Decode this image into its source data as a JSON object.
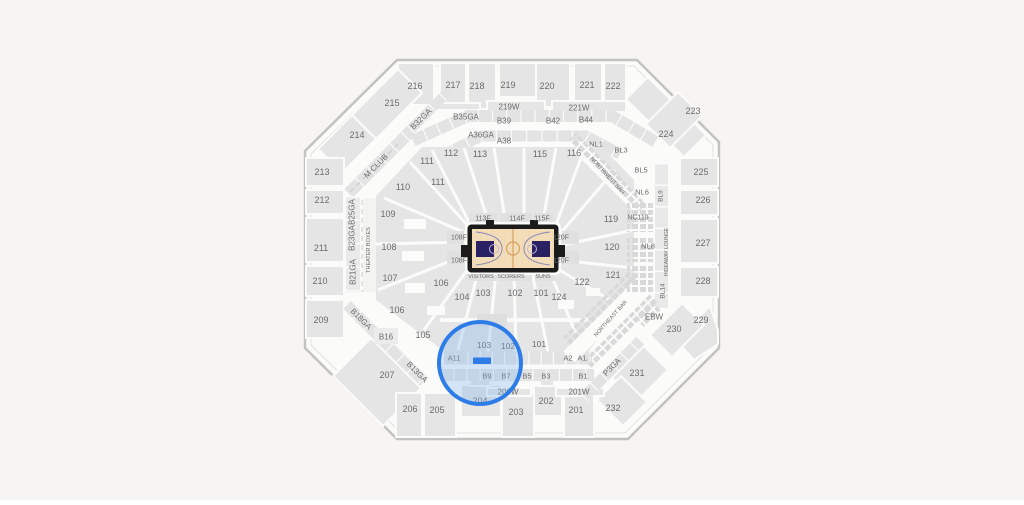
{
  "map_title": "Arena seating map with selected section highlighted",
  "background": "#f6f5f3",
  "colors": {
    "section_fill": "#e5e5e5",
    "arena_floor": "#fbfbfa",
    "outline": "#c2c2c0",
    "label": "#6b6b6b",
    "court_floor": "#f2ddb8",
    "court_border": "#1b1b1b",
    "court_key": "#2a2163",
    "court_lines": "#d9a05f",
    "highlight_blue": "#2e7ce8"
  },
  "highlight": {
    "cx": 480,
    "cy": 363,
    "r": 41,
    "stroke": "#2e7ce8",
    "stroke_width": 4,
    "fill": "#7fb3ef",
    "fill_opacity": 0.32,
    "marker": {
      "x": 473,
      "y": 357.5,
      "w": 18,
      "h": 6.5,
      "fill": "#2e7ce8"
    }
  },
  "labels": [
    {
      "t": "216",
      "x": 415,
      "y": 86
    },
    {
      "t": "217",
      "x": 453,
      "y": 85
    },
    {
      "t": "218",
      "x": 477,
      "y": 86
    },
    {
      "t": "219",
      "x": 508,
      "y": 85
    },
    {
      "t": "220",
      "x": 547,
      "y": 86
    },
    {
      "t": "221",
      "x": 587,
      "y": 85
    },
    {
      "t": "222",
      "x": 613,
      "y": 86
    },
    {
      "t": "215",
      "x": 392,
      "y": 103
    },
    {
      "t": "223",
      "x": 693,
      "y": 111
    },
    {
      "t": "214",
      "x": 357,
      "y": 135
    },
    {
      "t": "224",
      "x": 666,
      "y": 134
    },
    {
      "t": "213",
      "x": 322,
      "y": 172
    },
    {
      "t": "225",
      "x": 701,
      "y": 172
    },
    {
      "t": "212",
      "x": 322,
      "y": 200
    },
    {
      "t": "226",
      "x": 703,
      "y": 200
    },
    {
      "t": "211",
      "x": 321,
      "y": 248
    },
    {
      "t": "227",
      "x": 703,
      "y": 243
    },
    {
      "t": "210",
      "x": 320,
      "y": 281
    },
    {
      "t": "228",
      "x": 703,
      "y": 281
    },
    {
      "t": "209",
      "x": 321,
      "y": 320
    },
    {
      "t": "229",
      "x": 701,
      "y": 320
    },
    {
      "t": "230",
      "x": 674,
      "y": 329
    },
    {
      "t": "231",
      "x": 637,
      "y": 373
    },
    {
      "t": "232",
      "x": 613,
      "y": 408
    },
    {
      "t": "207",
      "x": 387,
      "y": 375
    },
    {
      "t": "206",
      "x": 410,
      "y": 409
    },
    {
      "t": "205",
      "x": 437,
      "y": 410
    },
    {
      "t": "204",
      "x": 480,
      "y": 401
    },
    {
      "t": "203",
      "x": 516,
      "y": 412
    },
    {
      "t": "202",
      "x": 546,
      "y": 401
    },
    {
      "t": "201",
      "x": 576,
      "y": 410
    },
    {
      "t": "219W",
      "x": 509,
      "y": 107,
      "s": 8
    },
    {
      "t": "221W",
      "x": 579,
      "y": 108,
      "s": 8
    },
    {
      "t": "200W",
      "x": 508,
      "y": 392,
      "s": 8
    },
    {
      "t": "201W",
      "x": 579,
      "y": 392,
      "s": 8
    },
    {
      "t": "B35GA",
      "x": 466,
      "y": 117,
      "s": 8
    },
    {
      "t": "B39",
      "x": 504,
      "y": 121,
      "s": 8
    },
    {
      "t": "B42",
      "x": 553,
      "y": 121,
      "s": 8
    },
    {
      "t": "B44",
      "x": 586,
      "y": 120,
      "s": 8
    },
    {
      "t": "A36GA",
      "x": 481,
      "y": 135,
      "s": 8
    },
    {
      "t": "A38",
      "x": 504,
      "y": 141,
      "s": 8
    },
    {
      "t": "B32GA",
      "x": 421,
      "y": 119,
      "r": -45,
      "s": 8
    },
    {
      "t": "M CLUB",
      "x": 376,
      "y": 166,
      "r": -45,
      "s": 8
    },
    {
      "t": "B25GA",
      "x": 352,
      "y": 212,
      "r": -90,
      "s": 8
    },
    {
      "t": "B23GA",
      "x": 352,
      "y": 238,
      "r": -90,
      "s": 8
    },
    {
      "t": "B21GA",
      "x": 353,
      "y": 272,
      "r": -90,
      "s": 8
    },
    {
      "t": "THEATER BOXES",
      "x": 369,
      "y": 250,
      "r": -90,
      "s": 5.5,
      "i": false
    },
    {
      "t": "B18GA",
      "x": 361,
      "y": 319,
      "r": 45,
      "s": 8
    },
    {
      "t": "B16",
      "x": 386,
      "y": 337,
      "s": 8
    },
    {
      "t": "B13GA",
      "x": 417,
      "y": 372,
      "r": 45,
      "s": 8
    },
    {
      "t": "P3GA",
      "x": 612,
      "y": 367,
      "r": -45,
      "s": 8
    },
    {
      "t": "110",
      "x": 403,
      "y": 187
    },
    {
      "t": "111",
      "x": 427,
      "y": 161
    },
    {
      "t": "111",
      "x": 438,
      "y": 182
    },
    {
      "t": "112",
      "x": 451,
      "y": 153
    },
    {
      "t": "113",
      "x": 480,
      "y": 154
    },
    {
      "t": "115",
      "x": 540,
      "y": 154
    },
    {
      "t": "116",
      "x": 574,
      "y": 153
    },
    {
      "t": "109",
      "x": 388,
      "y": 214
    },
    {
      "t": "108",
      "x": 389,
      "y": 247
    },
    {
      "t": "107",
      "x": 390,
      "y": 278
    },
    {
      "t": "106",
      "x": 441,
      "y": 283
    },
    {
      "t": "106",
      "x": 397,
      "y": 310
    },
    {
      "t": "105",
      "x": 423,
      "y": 335
    },
    {
      "t": "104",
      "x": 462,
      "y": 297
    },
    {
      "t": "103",
      "x": 483,
      "y": 293
    },
    {
      "t": "102",
      "x": 515,
      "y": 293
    },
    {
      "t": "101",
      "x": 541,
      "y": 293
    },
    {
      "t": "124",
      "x": 559,
      "y": 297
    },
    {
      "t": "122",
      "x": 582,
      "y": 282
    },
    {
      "t": "121",
      "x": 613,
      "y": 275
    },
    {
      "t": "120",
      "x": 612,
      "y": 247
    },
    {
      "t": "119",
      "x": 611,
      "y": 219
    },
    {
      "t": "103",
      "x": 484,
      "y": 345,
      "s": 8.5
    },
    {
      "t": "102",
      "x": 508,
      "y": 346,
      "s": 8.5
    },
    {
      "t": "101",
      "x": 539,
      "y": 344,
      "s": 8.5
    },
    {
      "t": "A11",
      "x": 454,
      "y": 358,
      "s": 7.5
    },
    {
      "t": "A2",
      "x": 568,
      "y": 358,
      "s": 7.5
    },
    {
      "t": "A1",
      "x": 582,
      "y": 358,
      "s": 7.5
    },
    {
      "t": "B9",
      "x": 487,
      "y": 376,
      "s": 7.5
    },
    {
      "t": "B7",
      "x": 506,
      "y": 376,
      "s": 7.5
    },
    {
      "t": "B5",
      "x": 527,
      "y": 376,
      "s": 7.5
    },
    {
      "t": "B3",
      "x": 546,
      "y": 376,
      "s": 7.5
    },
    {
      "t": "B1",
      "x": 583,
      "y": 376,
      "s": 7.5
    },
    {
      "t": "113F",
      "x": 483,
      "y": 219,
      "s": 7
    },
    {
      "t": "114F",
      "x": 517,
      "y": 219,
      "s": 7
    },
    {
      "t": "115F",
      "x": 542,
      "y": 219,
      "s": 7
    },
    {
      "t": "108F",
      "x": 459,
      "y": 238,
      "s": 7
    },
    {
      "t": "108F",
      "x": 459,
      "y": 261,
      "s": 7
    },
    {
      "t": "120F",
      "x": 561,
      "y": 238,
      "s": 7
    },
    {
      "t": "120F",
      "x": 561,
      "y": 261,
      "s": 7
    },
    {
      "t": "VISITORS",
      "x": 481,
      "y": 277,
      "s": 5.5,
      "i": false
    },
    {
      "t": "SCORERS",
      "x": 511,
      "y": 277,
      "s": 5.5,
      "i": false
    },
    {
      "t": "SUNS",
      "x": 543,
      "y": 277,
      "s": 5.5,
      "i": false
    },
    {
      "t": "NL1",
      "x": 596,
      "y": 144,
      "s": 7.5
    },
    {
      "t": "BL3",
      "x": 621,
      "y": 150,
      "s": 7.5
    },
    {
      "t": "BL5",
      "x": 641,
      "y": 170,
      "s": 7.5
    },
    {
      "t": "NL6",
      "x": 642,
      "y": 192,
      "s": 7.5
    },
    {
      "t": "NC119",
      "x": 638,
      "y": 218,
      "s": 7
    },
    {
      "t": "NL8",
      "x": 648,
      "y": 246,
      "s": 7.5
    },
    {
      "t": "BL9",
      "x": 661,
      "y": 196,
      "r": -90,
      "s": 6.5
    },
    {
      "t": "HIDEAWAY LOUNGE",
      "x": 667,
      "y": 252,
      "r": -90,
      "s": 5,
      "i": false
    },
    {
      "t": "BL14",
      "x": 663,
      "y": 291,
      "r": -90,
      "s": 6.5
    },
    {
      "t": "EBW",
      "x": 654,
      "y": 317,
      "s": 8
    },
    {
      "t": "NORTHWEST BAR",
      "x": 607,
      "y": 176,
      "r": 48,
      "s": 5.5,
      "i": false
    },
    {
      "t": "NORTHEAST BAR",
      "x": 611,
      "y": 319,
      "r": -48,
      "s": 5.5,
      "i": false
    }
  ]
}
